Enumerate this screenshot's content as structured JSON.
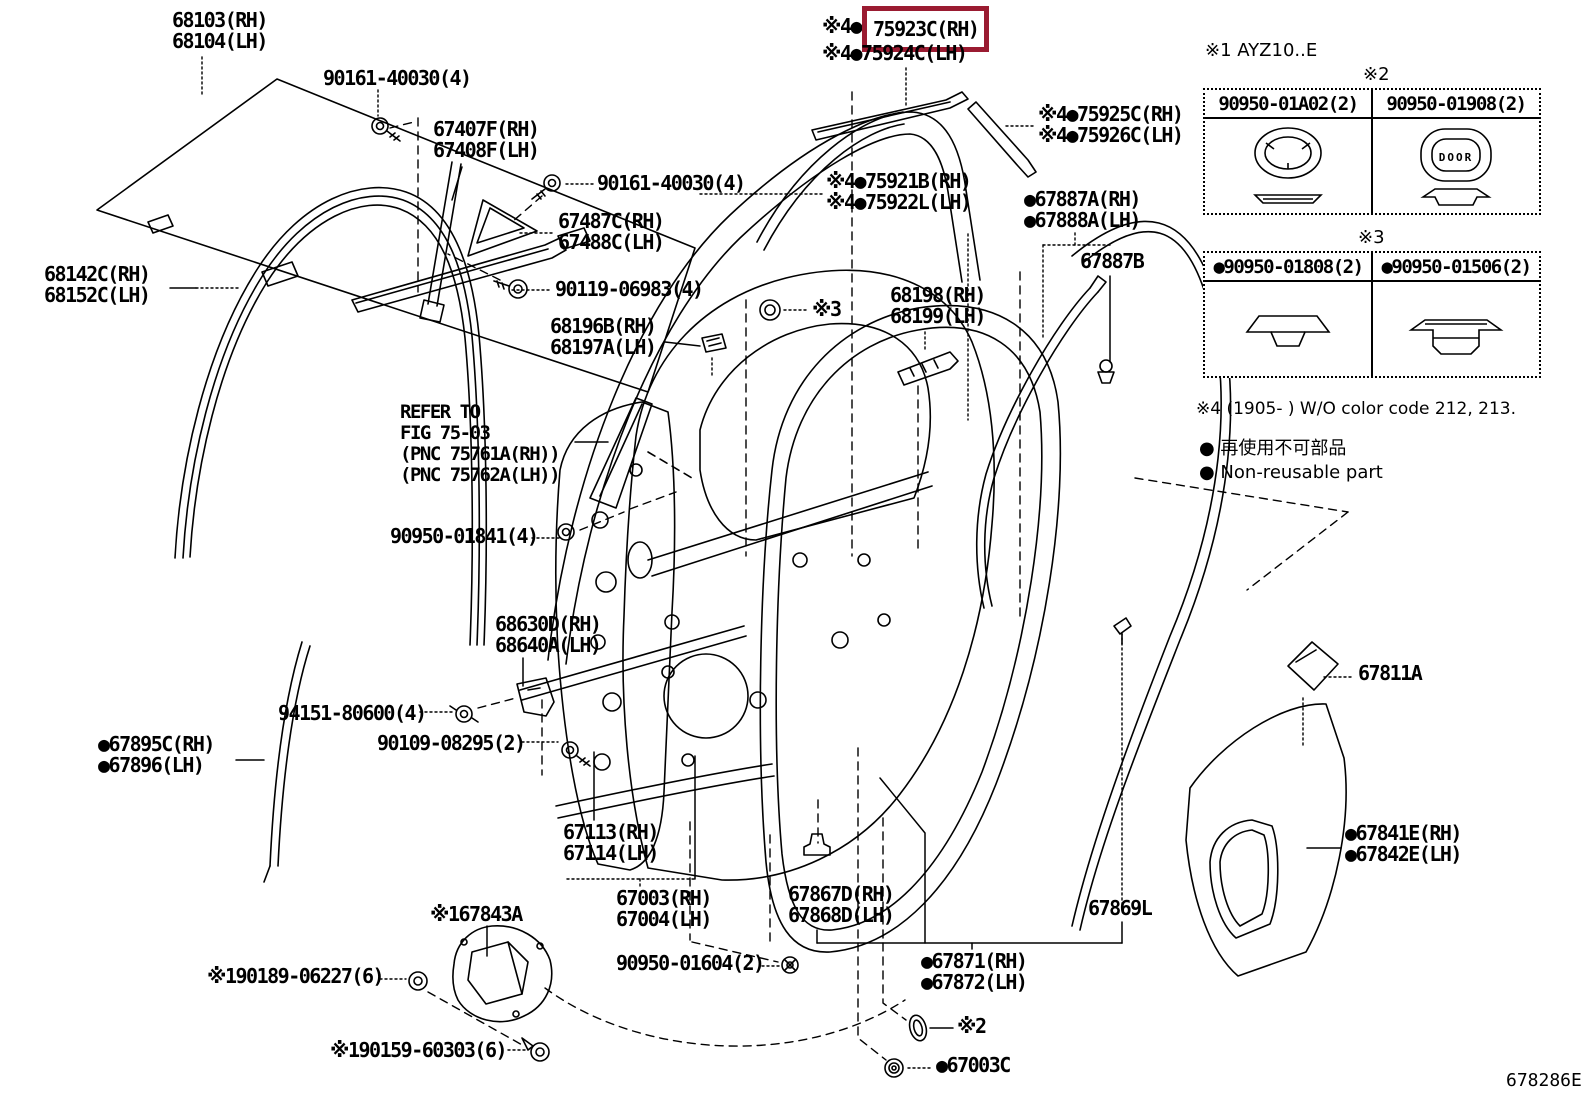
{
  "figure": {
    "code": "678286E"
  },
  "highlight": {
    "color": "#9a1b31",
    "prefix": "※4●",
    "part": "75923C(RH)"
  },
  "notes": {
    "note1": "※1 AYZ10..E",
    "mark2": "※2",
    "mark3": "※3",
    "note4": "※4 (1905-      )  W/O color code 212, 213.",
    "nonreusable_jp": "● 再使用不可部品",
    "nonreusable_en": "● Non-reusable part"
  },
  "tables": {
    "t2": {
      "cols": [
        "90950-01A02(2)",
        "90950-01908(2)"
      ],
      "door_text": "DOOR"
    },
    "t3": {
      "cols": [
        "●90950-01808(2)",
        "●90950-01506(2)"
      ]
    }
  },
  "labels": {
    "l68103": {
      "lines": [
        "68103(RH)",
        "68104(LH)"
      ]
    },
    "l90161a": {
      "lines": [
        "90161-40030(4)"
      ]
    },
    "l67407": {
      "lines": [
        "67407F(RH)",
        "67408F(LH)"
      ]
    },
    "l90161b": {
      "lines": [
        "90161-40030(4)"
      ]
    },
    "l67487": {
      "lines": [
        "67487C(RH)",
        "67488C(LH)"
      ]
    },
    "l68142": {
      "lines": [
        "68142C(RH)",
        "68152C(LH)"
      ]
    },
    "l90119": {
      "lines": [
        "90119-06983(4)"
      ]
    },
    "l68196": {
      "lines": [
        "68196B(RH)",
        "68197A(LH)"
      ]
    },
    "lrefer": {
      "lines": [
        "REFER TO",
        "FIG 75-03",
        "(PNC 75761A(RH))",
        "(PNC 75762A(LH))"
      ]
    },
    "l90950_01841": {
      "lines": [
        "90950-01841(4)"
      ]
    },
    "l68630": {
      "lines": [
        "68630D(RH)",
        "68640A(LH)"
      ]
    },
    "l94151": {
      "lines": [
        "94151-80600(4)"
      ]
    },
    "l90109": {
      "lines": [
        "90109-08295(2)"
      ]
    },
    "l67895": {
      "lines": [
        "●67895C(RH)",
        "●67896(LH)"
      ]
    },
    "l67113": {
      "lines": [
        "67113(RH)",
        "67114(LH)"
      ]
    },
    "l67003": {
      "lines": [
        "67003(RH)",
        "67004(LH)"
      ]
    },
    "l67843": {
      "lines": [
        "※167843A"
      ]
    },
    "l90189": {
      "lines": [
        "※190189-06227(6)"
      ]
    },
    "l90159": {
      "lines": [
        "※190159-60303(6)"
      ]
    },
    "l90950_01604": {
      "lines": [
        "90950-01604(2)"
      ]
    },
    "l67867": {
      "lines": [
        "67867D(RH)",
        "67868D(LH)"
      ]
    },
    "l67871": {
      "lines": [
        "●67871(RH)",
        "●67872(LH)"
      ]
    },
    "ls2b": {
      "lines": [
        "※2"
      ]
    },
    "l67003C": {
      "lines": [
        "●67003C"
      ]
    },
    "l67869": {
      "lines": [
        "67869L"
      ]
    },
    "l67811": {
      "lines": [
        "67811A"
      ]
    },
    "l67841": {
      "lines": [
        "●67841E(RH)",
        "●67842E(LH)"
      ]
    },
    "l75924": {
      "lines": [
        "※4●75924C(LH)"
      ]
    },
    "l75925": {
      "lines": [
        "※4●75925C(RH)",
        "※4●75926C(LH)"
      ]
    },
    "l75921": {
      "lines": [
        "※4●75921B(RH)",
        "※4●75922L(LH)"
      ]
    },
    "l67887A": {
      "lines": [
        "●67887A(RH)",
        "●67888A(LH)"
      ]
    },
    "l67887B": {
      "lines": [
        "67887B"
      ]
    },
    "l68198": {
      "lines": [
        "68198(RH)",
        "68199(LH)"
      ]
    },
    "ls3": {
      "lines": [
        "※3"
      ]
    }
  }
}
